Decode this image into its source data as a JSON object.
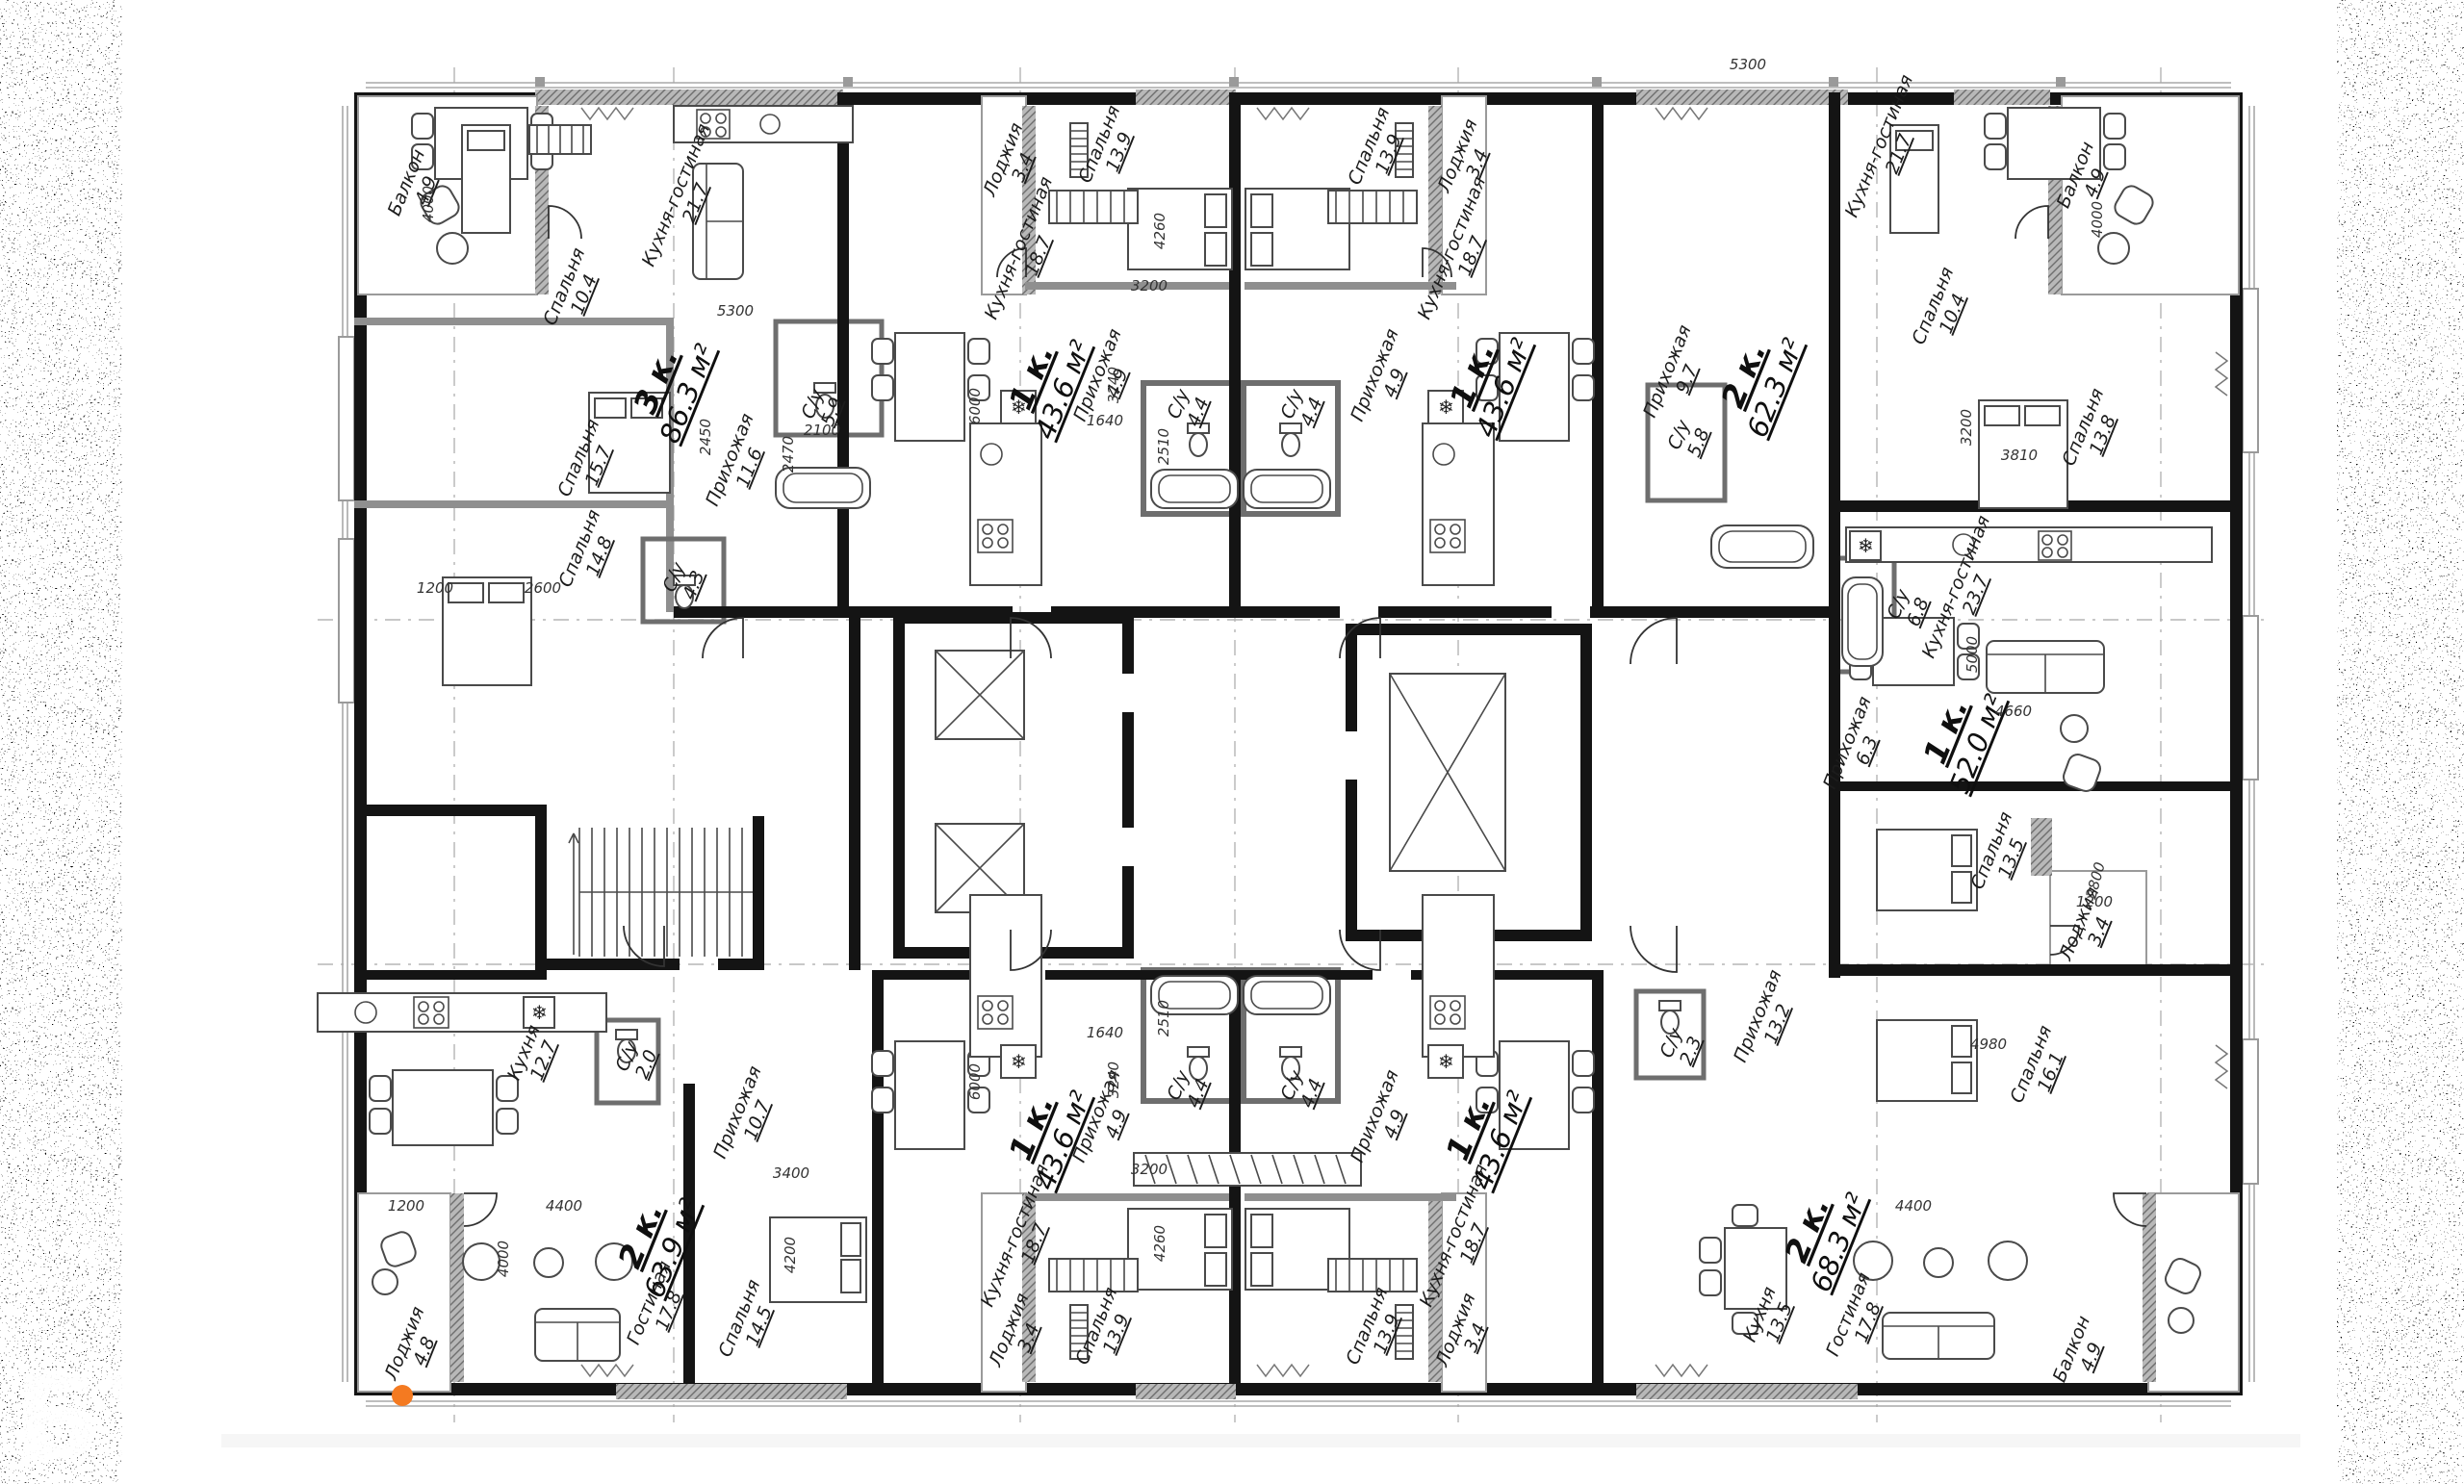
{
  "colors": {
    "wall": "#141414",
    "hatch_gray": "#b8b8b8",
    "accent_orange": "#f47a21",
    "paper": "#ffffff"
  },
  "plan": {
    "apartments": [
      {
        "type": "3 к.",
        "area": "86.3 м²"
      },
      {
        "type": "1 к.",
        "area": "43.6 м²"
      },
      {
        "type": "1 к.",
        "area": "43.6 м²"
      },
      {
        "type": "2 к.",
        "area": "62.3 м²"
      },
      {
        "type": "1 к.",
        "area": "52.0 м²"
      },
      {
        "type": "1 к.",
        "area": "43.6 м²"
      },
      {
        "type": "1 к.",
        "area": "43.6 м²"
      },
      {
        "type": "2 к.",
        "area": "63.9 м²"
      },
      {
        "type": "2 к.",
        "area": "68.3 м²"
      }
    ],
    "rooms": [
      {
        "n": "Балкон",
        "a": "4.9"
      },
      {
        "n": "Спальня",
        "a": "10.4"
      },
      {
        "n": "Кухня-гостиная",
        "a": "21.7"
      },
      {
        "n": "Спальня",
        "a": "15.7"
      },
      {
        "n": "Спальня",
        "a": "14.8"
      },
      {
        "n": "С/у",
        "a": "4.3"
      },
      {
        "n": "Прихожая",
        "a": "11.6"
      },
      {
        "n": "С/у",
        "a": "5.9"
      },
      {
        "n": "Лоджия",
        "a": "3.4"
      },
      {
        "n": "Спальня",
        "a": "13.9"
      },
      {
        "n": "Кухня-гостиная",
        "a": "18.7"
      },
      {
        "n": "Прихожая",
        "a": "4.9"
      },
      {
        "n": "С/у",
        "a": "4.4"
      },
      {
        "n": "Спальня",
        "a": "13.9"
      },
      {
        "n": "Лоджия",
        "a": "3.4"
      },
      {
        "n": "Кухня-гостиная",
        "a": "18.7"
      },
      {
        "n": "Прихожая",
        "a": "4.9"
      },
      {
        "n": "С/у",
        "a": "4.4"
      },
      {
        "n": "Кухня-гостиная",
        "a": "21.7"
      },
      {
        "n": "Спальня",
        "a": "10.4"
      },
      {
        "n": "Балкон",
        "a": "4.9"
      },
      {
        "n": "Прихожая",
        "a": "9.7"
      },
      {
        "n": "С/у",
        "a": "5.8"
      },
      {
        "n": "Спальня",
        "a": "13.8"
      },
      {
        "n": "Кухня-гостиная",
        "a": "23.7"
      },
      {
        "n": "Прихожая",
        "a": "6.3"
      },
      {
        "n": "С/у",
        "a": "6.8"
      },
      {
        "n": "Спальня",
        "a": "13.5"
      },
      {
        "n": "Лоджия",
        "a": "3.4"
      },
      {
        "n": "Кухня",
        "a": "12.7"
      },
      {
        "n": "С/у",
        "a": "2.0"
      },
      {
        "n": "Прихожая",
        "a": "10.7"
      },
      {
        "n": "Гостиная",
        "a": "17.8"
      },
      {
        "n": "Спальня",
        "a": "14.5"
      },
      {
        "n": "Лоджия",
        "a": "4.8"
      },
      {
        "n": "Кухня-гостиная",
        "a": "18.7"
      },
      {
        "n": "Прихожая",
        "a": "4.9"
      },
      {
        "n": "С/у",
        "a": "4.4"
      },
      {
        "n": "Спальня",
        "a": "13.9"
      },
      {
        "n": "Лоджия",
        "a": "3.4"
      },
      {
        "n": "Кухня-гостиная",
        "a": "18.7"
      },
      {
        "n": "Прихожая",
        "a": "4.9"
      },
      {
        "n": "С/у",
        "a": "4.4"
      },
      {
        "n": "Спальня",
        "a": "13.9"
      },
      {
        "n": "Лоджия",
        "a": "3.4"
      },
      {
        "n": "Прихожая",
        "a": "13.2"
      },
      {
        "n": "С/у",
        "a": "2.3"
      },
      {
        "n": "Кухня",
        "a": "13.5"
      },
      {
        "n": "Гостиная",
        "a": "17.8"
      },
      {
        "n": "Спальня",
        "a": "16.1"
      },
      {
        "n": "Балкон",
        "a": "4.9"
      }
    ],
    "dims": [
      "4000",
      "1200",
      "2600",
      "5300",
      "5300",
      "6000",
      "3200",
      "4260",
      "3240",
      "1640",
      "2510",
      "2100",
      "2470",
      "2450",
      "3200",
      "4260",
      "3240",
      "1640",
      "2510",
      "4400",
      "4200",
      "3400",
      "4000",
      "1200",
      "4400",
      "4000",
      "5000",
      "4660",
      "2800",
      "1200",
      "4980",
      "3810",
      "3200",
      "6000"
    ],
    "icons": {
      "fridge": "❄"
    },
    "watermark": {
      "letters": "БУ"
    }
  }
}
